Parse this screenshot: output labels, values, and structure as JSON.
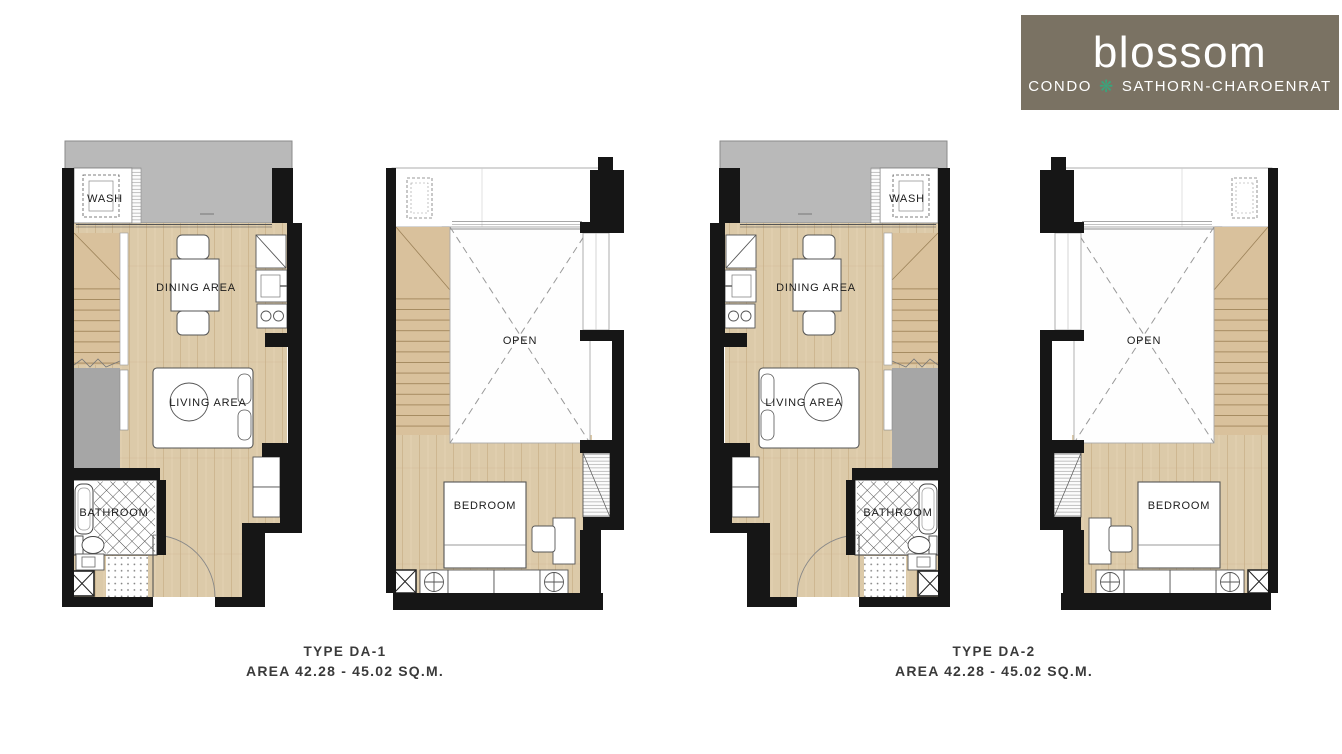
{
  "logo": {
    "brand": "blossom",
    "subtitle_prefix": "CONDO",
    "flower_icon": "❋",
    "subtitle_suffix": "SATHORN-CHAROENRAT"
  },
  "plans": {
    "lower": {
      "labels": {
        "wash": "WASH",
        "dining": "DINING AREA",
        "living": "LIVING AREA",
        "bathroom": "BATHROOM"
      }
    },
    "upper": {
      "labels": {
        "open": "OPEN",
        "bedroom": "BEDROOM"
      }
    }
  },
  "units": [
    {
      "type_label": "TYPE DA-1",
      "area_label": "AREA 42.28 - 45.02 SQ.M."
    },
    {
      "type_label": "TYPE DA-2",
      "area_label": "AREA 42.28 - 45.02 SQ.M."
    }
  ],
  "colors": {
    "wall": "#161616",
    "wood": "#dccaa9",
    "balcony_gray": "#b9b9b9",
    "void_gray": "#a6a6a6",
    "logo_bg": "#7a7263",
    "logo_green": "#39a57c"
  }
}
